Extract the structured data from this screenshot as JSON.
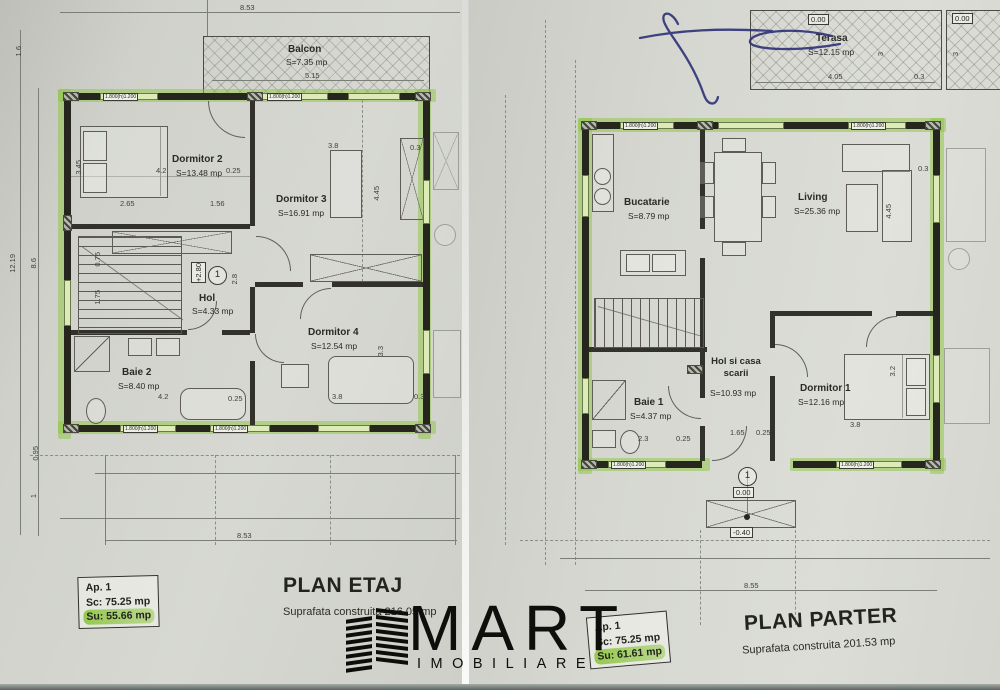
{
  "colors": {
    "highlight_green": "#8dc63f",
    "wall_black": "#26261f",
    "paper": "#d2d3ce",
    "pen_blue": "#2d3178"
  },
  "logo": {
    "brand": "MART",
    "tagline": "IMOBILIARE"
  },
  "window_label": "1.800(h)1.200",
  "etaj": {
    "title": "PLAN ETAJ",
    "built_area": "Suprafata construita 216.05 mp",
    "apartment": {
      "id": "Ap. 1",
      "sc": "Sc: 75.25 mp",
      "su": "Su: 55.66 mp"
    },
    "story": "1",
    "level": "+2.80",
    "rooms": {
      "balcon": {
        "name": "Balcon",
        "area": "S=7.35 mp"
      },
      "dormitor2": {
        "name": "Dormitor 2",
        "area": "S=13.48 mp"
      },
      "dormitor3": {
        "name": "Dormitor 3",
        "area": "S=16.91 mp"
      },
      "hol": {
        "name": "Hol",
        "area": "S=4.33 mp"
      },
      "dormitor4": {
        "name": "Dormitor 4",
        "area": "S=12.54 mp"
      },
      "baie2": {
        "name": "Baie 2",
        "area": "S=8.40 mp"
      }
    },
    "dims": {
      "top": "8.53",
      "bottom": "8.53",
      "left_total": "12.19",
      "left_inner": "8.6",
      "top_left": "1.6",
      "below_a": "0.95",
      "below_b": "1",
      "balcon": "5.15",
      "d2_w": "4.2",
      "d2_off": "0.25",
      "d2_a": "2.65",
      "d2_b": "1.56",
      "d2_h": "3.45",
      "d3_w": "3.8",
      "d3_h": "4.45",
      "d3_off": "0.3",
      "d4_w": "3.8",
      "d4_h": "3.3",
      "d4_off": "0.3",
      "baie_w": "4.2",
      "baie_off": "0.25",
      "stair_a": "0.75",
      "stair_b": "1.75",
      "hol_h": "2.8"
    }
  },
  "parter": {
    "title": "PLAN PARTER",
    "built_area": "Suprafata construita 201.53 mp",
    "apartment": {
      "id": "Ap. 1",
      "sc": "Sc: 75.25 mp",
      "su": "Su: 61.61 mp"
    },
    "story": "1",
    "levels": {
      "terasa": "0.00",
      "terasa2": "0.00",
      "entry": "0.00",
      "entry_low": "-0.40"
    },
    "rooms": {
      "terasa": {
        "name": "Terasa",
        "area": "S=12.15 mp"
      },
      "bucatarie": {
        "name": "Bucatarie",
        "area": "S=8.79 mp"
      },
      "living": {
        "name": "Living",
        "area": "S=25.36 mp"
      },
      "hol": {
        "name": "Hol si casa scarii",
        "area": "S=10.93 mp"
      },
      "baie1": {
        "name": "Baie 1",
        "area": "S=4.37 mp"
      },
      "dormitor1": {
        "name": "Dormitor 1",
        "area": "S=12.16 mp"
      }
    },
    "dims": {
      "terasa_w": "4.05",
      "terasa_off": "0.3",
      "terasa_h": "3",
      "terasa_h2": "3",
      "bottom": "8.55",
      "living_h": "4.45",
      "living_off": "0.3",
      "d1_w": "3.8",
      "d1_h": "3.2",
      "hol_a": "1.65",
      "hol_b": "0.25",
      "baie_a": "2.3",
      "baie_b": "0.25"
    }
  }
}
